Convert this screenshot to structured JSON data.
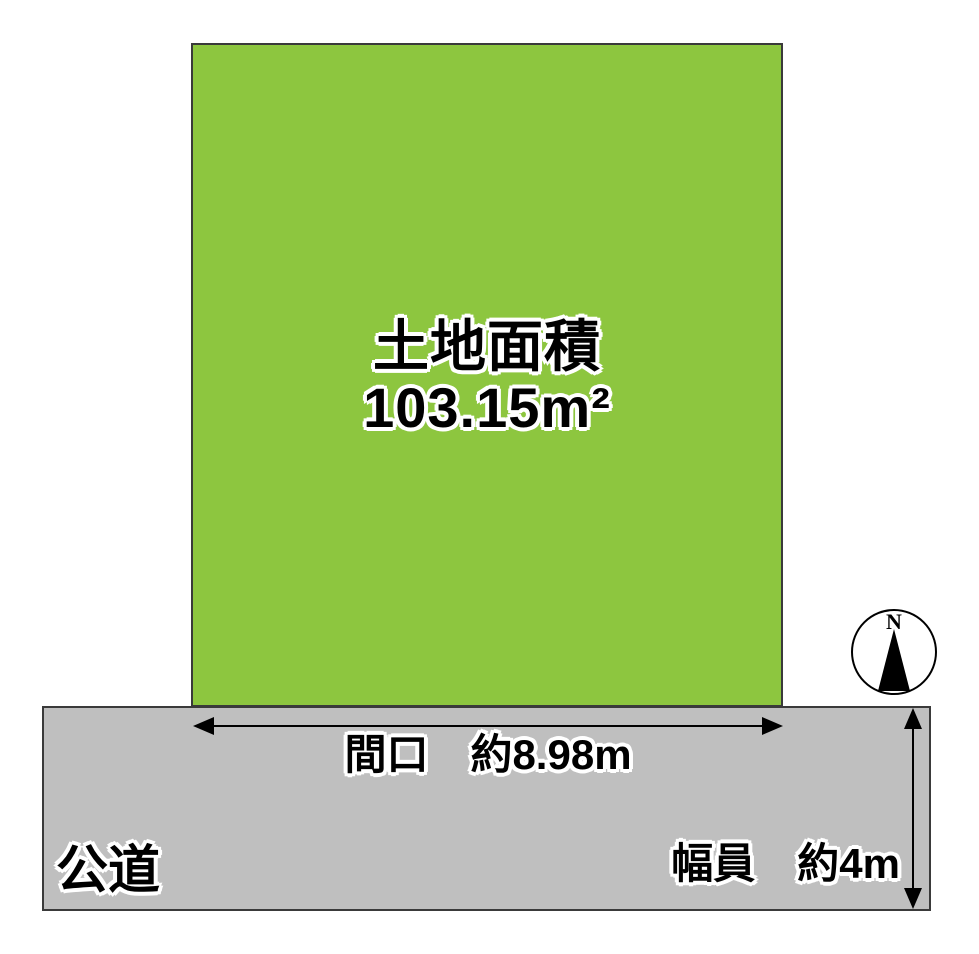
{
  "diagram": {
    "land": {
      "title": "土地面積",
      "area": "103.15m²"
    },
    "road": {
      "label": "公道"
    },
    "frontage_label": "間口　約8.98m",
    "width_label": "幅員　約4m",
    "compass": {
      "label": "N"
    },
    "colors": {
      "land_fill": "#8dc63f",
      "road_fill": "#bfbfbf",
      "border": "#3a3a3a",
      "line": "#000000"
    }
  }
}
